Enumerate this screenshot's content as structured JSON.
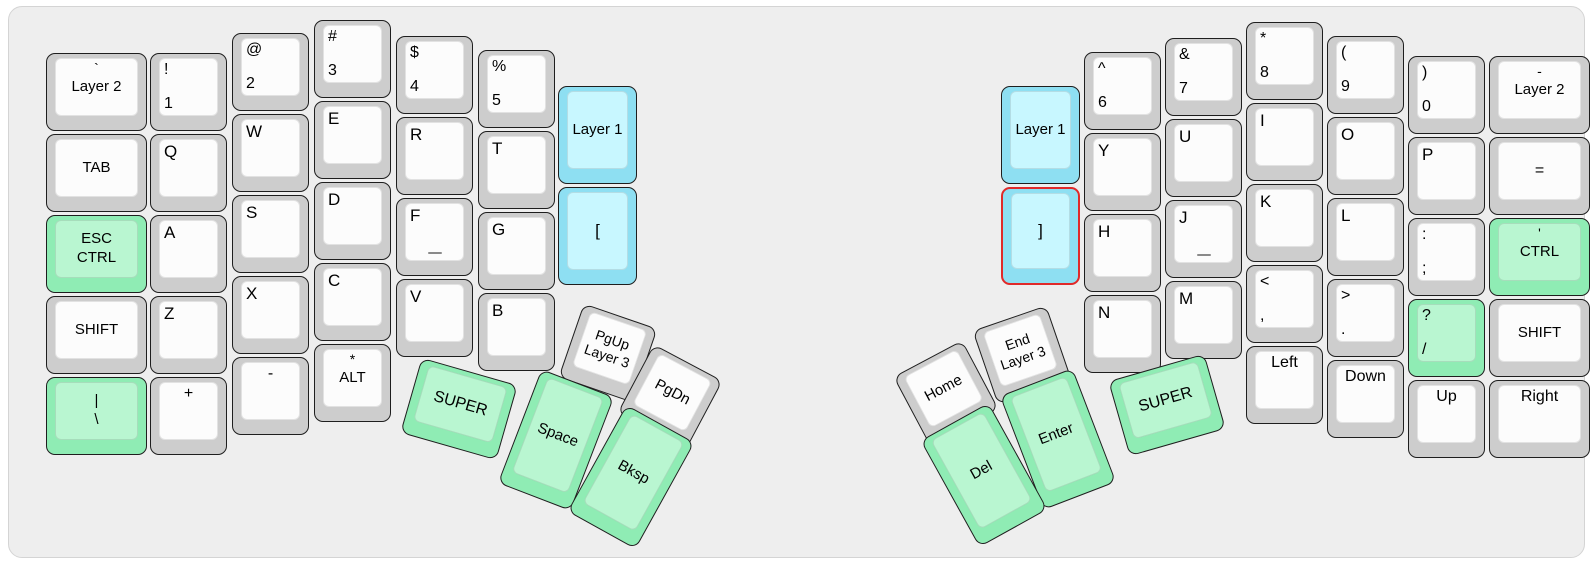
{
  "app": {
    "view_title": "split keyboard layout preview"
  },
  "colors": {
    "board_bg": "#eeeeee",
    "key_border": "#1e1e1e",
    "key_gray": "#cdcdcd",
    "key_gray_top": "#fcfcfc",
    "key_green": "#8fecb4",
    "key_green_top": "#b9f6d1",
    "key_blue": "#8edff2",
    "key_blue_top": "#c8f7ff",
    "red_border": "#e02929"
  },
  "keys": [
    {
      "n": "key-backtick-layer2",
      "x": 37,
      "y": 46,
      "w": 101,
      "h": 78,
      "r": 0,
      "c": "gray",
      "lg": [
        {
          "t": "`",
          "p": "tc",
          "s": 14
        },
        {
          "t": "Layer 2",
          "p": "cc",
          "s": 15
        }
      ]
    },
    {
      "n": "key-tab",
      "x": 37,
      "y": 127,
      "w": 101,
      "h": 78,
      "r": 0,
      "c": "gray",
      "lg": [
        {
          "t": "TAB",
          "p": "cc",
          "s": 15
        }
      ]
    },
    {
      "n": "key-esc-ctrl",
      "x": 37,
      "y": 208,
      "w": 101,
      "h": 78,
      "r": 0,
      "c": "green",
      "lg": [
        {
          "t": "ESC\nCTRL",
          "p": "cc",
          "s": 15
        }
      ]
    },
    {
      "n": "key-shift-left",
      "x": 37,
      "y": 289,
      "w": 101,
      "h": 78,
      "r": 0,
      "c": "gray",
      "lg": [
        {
          "t": "SHIFT",
          "p": "cc",
          "s": 15
        }
      ]
    },
    {
      "n": "key-pipe-backslash",
      "x": 37,
      "y": 370,
      "w": 101,
      "h": 78,
      "r": 0,
      "c": "green",
      "lg": [
        {
          "t": "|\n\\",
          "p": "cc",
          "s": 15
        }
      ]
    },
    {
      "n": "key-exclam-1",
      "x": 141,
      "y": 46,
      "w": 77,
      "h": 78,
      "r": 0,
      "c": "gray",
      "lg": [
        {
          "t": "!",
          "p": "tl",
          "s": 16
        },
        {
          "t": "1",
          "p": "bl",
          "s": 16
        }
      ]
    },
    {
      "n": "key-q",
      "x": 141,
      "y": 127,
      "w": 77,
      "h": 78,
      "r": 0,
      "c": "gray",
      "lg": [
        {
          "t": "Q",
          "p": "tl",
          "s": 17
        }
      ]
    },
    {
      "n": "key-a",
      "x": 141,
      "y": 208,
      "w": 77,
      "h": 78,
      "r": 0,
      "c": "gray",
      "lg": [
        {
          "t": "A",
          "p": "tl",
          "s": 17
        }
      ]
    },
    {
      "n": "key-z",
      "x": 141,
      "y": 289,
      "w": 77,
      "h": 78,
      "r": 0,
      "c": "gray",
      "lg": [
        {
          "t": "Z",
          "p": "tl",
          "s": 17
        }
      ]
    },
    {
      "n": "key-plus",
      "x": 141,
      "y": 370,
      "w": 77,
      "h": 78,
      "r": 0,
      "c": "gray",
      "lg": [
        {
          "t": "+",
          "p": "tc",
          "s": 16
        }
      ]
    },
    {
      "n": "key-at-2",
      "x": 223,
      "y": 26,
      "w": 77,
      "h": 78,
      "r": 0,
      "c": "gray",
      "lg": [
        {
          "t": "@",
          "p": "tl",
          "s": 16
        },
        {
          "t": "2",
          "p": "bl",
          "s": 16
        }
      ]
    },
    {
      "n": "key-w",
      "x": 223,
      "y": 107,
      "w": 77,
      "h": 78,
      "r": 0,
      "c": "gray",
      "lg": [
        {
          "t": "W",
          "p": "tl",
          "s": 17
        }
      ]
    },
    {
      "n": "key-s",
      "x": 223,
      "y": 188,
      "w": 77,
      "h": 78,
      "r": 0,
      "c": "gray",
      "lg": [
        {
          "t": "S",
          "p": "tl",
          "s": 17
        }
      ]
    },
    {
      "n": "key-x",
      "x": 223,
      "y": 269,
      "w": 77,
      "h": 78,
      "r": 0,
      "c": "gray",
      "lg": [
        {
          "t": "X",
          "p": "tl",
          "s": 17
        }
      ]
    },
    {
      "n": "key-minus",
      "x": 223,
      "y": 350,
      "w": 77,
      "h": 78,
      "r": 0,
      "c": "gray",
      "lg": [
        {
          "t": "-",
          "p": "tc",
          "s": 16
        }
      ]
    },
    {
      "n": "key-hash-3",
      "x": 305,
      "y": 13,
      "w": 77,
      "h": 78,
      "r": 0,
      "c": "gray",
      "lg": [
        {
          "t": "#",
          "p": "tl",
          "s": 16
        },
        {
          "t": "3",
          "p": "bl",
          "s": 16
        }
      ]
    },
    {
      "n": "key-e",
      "x": 305,
      "y": 94,
      "w": 77,
      "h": 78,
      "r": 0,
      "c": "gray",
      "lg": [
        {
          "t": "E",
          "p": "tl",
          "s": 17
        }
      ]
    },
    {
      "n": "key-d",
      "x": 305,
      "y": 175,
      "w": 77,
      "h": 78,
      "r": 0,
      "c": "gray",
      "lg": [
        {
          "t": "D",
          "p": "tl",
          "s": 17
        }
      ]
    },
    {
      "n": "key-c",
      "x": 305,
      "y": 256,
      "w": 77,
      "h": 78,
      "r": 0,
      "c": "gray",
      "lg": [
        {
          "t": "C",
          "p": "tl",
          "s": 17
        }
      ]
    },
    {
      "n": "key-star-alt",
      "x": 305,
      "y": 337,
      "w": 77,
      "h": 78,
      "r": 0,
      "c": "gray",
      "lg": [
        {
          "t": "*",
          "p": "tc",
          "s": 14
        },
        {
          "t": "ALT",
          "p": "cc",
          "s": 15
        }
      ]
    },
    {
      "n": "key-dollar-4",
      "x": 387,
      "y": 29,
      "w": 77,
      "h": 78,
      "r": 0,
      "c": "gray",
      "lg": [
        {
          "t": "$",
          "p": "tl",
          "s": 16
        },
        {
          "t": "4",
          "p": "bl",
          "s": 16
        }
      ]
    },
    {
      "n": "key-r",
      "x": 387,
      "y": 110,
      "w": 77,
      "h": 78,
      "r": 0,
      "c": "gray",
      "lg": [
        {
          "t": "R",
          "p": "tl",
          "s": 17
        }
      ]
    },
    {
      "n": "key-f",
      "x": 387,
      "y": 191,
      "w": 77,
      "h": 78,
      "r": 0,
      "c": "gray",
      "hm": true,
      "lg": [
        {
          "t": "F",
          "p": "tl",
          "s": 17
        }
      ]
    },
    {
      "n": "key-v",
      "x": 387,
      "y": 272,
      "w": 77,
      "h": 78,
      "r": 0,
      "c": "gray",
      "lg": [
        {
          "t": "V",
          "p": "tl",
          "s": 17
        }
      ]
    },
    {
      "n": "key-percent-5",
      "x": 469,
      "y": 43,
      "w": 77,
      "h": 78,
      "r": 0,
      "c": "gray",
      "lg": [
        {
          "t": "%",
          "p": "tl",
          "s": 16
        },
        {
          "t": "5",
          "p": "bl",
          "s": 16
        }
      ]
    },
    {
      "n": "key-t",
      "x": 469,
      "y": 124,
      "w": 77,
      "h": 78,
      "r": 0,
      "c": "gray",
      "lg": [
        {
          "t": "T",
          "p": "tl",
          "s": 17
        }
      ]
    },
    {
      "n": "key-g",
      "x": 469,
      "y": 205,
      "w": 77,
      "h": 78,
      "r": 0,
      "c": "gray",
      "lg": [
        {
          "t": "G",
          "p": "tl",
          "s": 17
        }
      ]
    },
    {
      "n": "key-b",
      "x": 469,
      "y": 286,
      "w": 77,
      "h": 78,
      "r": 0,
      "c": "gray",
      "lg": [
        {
          "t": "B",
          "p": "tl",
          "s": 17
        }
      ]
    },
    {
      "n": "key-layer1-left",
      "x": 549,
      "y": 79,
      "w": 79,
      "h": 98,
      "r": 0,
      "c": "blue",
      "lg": [
        {
          "t": "Layer 1",
          "p": "cc",
          "s": 15
        }
      ]
    },
    {
      "n": "key-lbracket",
      "x": 549,
      "y": 180,
      "w": 79,
      "h": 98,
      "r": 0,
      "c": "blue",
      "lg": [
        {
          "t": "[",
          "p": "cc",
          "s": 17
        }
      ]
    },
    {
      "n": "key-pgup-layer3",
      "x": 560,
      "y": 307,
      "w": 78,
      "h": 78,
      "r": 19,
      "c": "gray",
      "lg": [
        {
          "t": "PgUp\nLayer 3",
          "p": "cc",
          "s": 14
        }
      ]
    },
    {
      "n": "key-pgdn",
      "x": 622,
      "y": 351,
      "w": 78,
      "h": 78,
      "r": 28,
      "c": "gray",
      "lg": [
        {
          "t": "PgDn",
          "p": "cc",
          "s": 15
        }
      ]
    },
    {
      "n": "key-super-left",
      "x": 400,
      "y": 363,
      "w": 100,
      "h": 78,
      "r": 16,
      "c": "green",
      "lg": [
        {
          "t": "SUPER",
          "p": "cc",
          "s": 16
        }
      ]
    },
    {
      "n": "key-space",
      "x": 508,
      "y": 372,
      "w": 78,
      "h": 122,
      "r": 21,
      "c": "green",
      "lg": [
        {
          "t": "Space",
          "p": "cc",
          "s": 15
        }
      ]
    },
    {
      "n": "key-bksp",
      "x": 583,
      "y": 409,
      "w": 78,
      "h": 122,
      "r": 29,
      "c": "green",
      "lg": [
        {
          "t": "Bksp",
          "p": "cc",
          "s": 15
        }
      ]
    },
    {
      "n": "key-layer1-right",
      "x": 992,
      "y": 79,
      "w": 79,
      "h": 98,
      "r": 0,
      "c": "blue",
      "lg": [
        {
          "t": "Layer 1",
          "p": "cc",
          "s": 15
        }
      ]
    },
    {
      "n": "key-rbracket",
      "x": 992,
      "y": 180,
      "w": 79,
      "h": 98,
      "r": 0,
      "c": "blue",
      "rb": true,
      "lg": [
        {
          "t": "]",
          "p": "cc",
          "s": 17
        }
      ]
    },
    {
      "n": "key-caret-6",
      "x": 1075,
      "y": 45,
      "w": 77,
      "h": 78,
      "r": 0,
      "c": "gray",
      "lg": [
        {
          "t": "^",
          "p": "tl",
          "s": 16
        },
        {
          "t": "6",
          "p": "bl",
          "s": 16
        }
      ]
    },
    {
      "n": "key-y",
      "x": 1075,
      "y": 126,
      "w": 77,
      "h": 78,
      "r": 0,
      "c": "gray",
      "lg": [
        {
          "t": "Y",
          "p": "tl",
          "s": 17
        }
      ]
    },
    {
      "n": "key-h",
      "x": 1075,
      "y": 207,
      "w": 77,
      "h": 78,
      "r": 0,
      "c": "gray",
      "lg": [
        {
          "t": "H",
          "p": "tl",
          "s": 17
        }
      ]
    },
    {
      "n": "key-n",
      "x": 1075,
      "y": 288,
      "w": 77,
      "h": 78,
      "r": 0,
      "c": "gray",
      "lg": [
        {
          "t": "N",
          "p": "tl",
          "s": 17
        }
      ]
    },
    {
      "n": "key-amp-7",
      "x": 1156,
      "y": 31,
      "w": 77,
      "h": 78,
      "r": 0,
      "c": "gray",
      "lg": [
        {
          "t": "&",
          "p": "tl",
          "s": 16
        },
        {
          "t": "7",
          "p": "bl",
          "s": 16
        }
      ]
    },
    {
      "n": "key-u",
      "x": 1156,
      "y": 112,
      "w": 77,
      "h": 78,
      "r": 0,
      "c": "gray",
      "lg": [
        {
          "t": "U",
          "p": "tl",
          "s": 17
        }
      ]
    },
    {
      "n": "key-j",
      "x": 1156,
      "y": 193,
      "w": 77,
      "h": 78,
      "r": 0,
      "c": "gray",
      "hm": true,
      "lg": [
        {
          "t": "J",
          "p": "tl",
          "s": 17
        }
      ]
    },
    {
      "n": "key-m",
      "x": 1156,
      "y": 274,
      "w": 77,
      "h": 78,
      "r": 0,
      "c": "gray",
      "lg": [
        {
          "t": "M",
          "p": "tl",
          "s": 17
        }
      ]
    },
    {
      "n": "key-star-8",
      "x": 1237,
      "y": 15,
      "w": 77,
      "h": 78,
      "r": 0,
      "c": "gray",
      "lg": [
        {
          "t": "*",
          "p": "tl",
          "s": 16
        },
        {
          "t": "8",
          "p": "bl",
          "s": 16
        }
      ]
    },
    {
      "n": "key-i",
      "x": 1237,
      "y": 96,
      "w": 77,
      "h": 78,
      "r": 0,
      "c": "gray",
      "lg": [
        {
          "t": "I",
          "p": "tl",
          "s": 17
        }
      ]
    },
    {
      "n": "key-k",
      "x": 1237,
      "y": 177,
      "w": 77,
      "h": 78,
      "r": 0,
      "c": "gray",
      "lg": [
        {
          "t": "K",
          "p": "tl",
          "s": 17
        }
      ]
    },
    {
      "n": "key-lt-comma",
      "x": 1237,
      "y": 258,
      "w": 77,
      "h": 78,
      "r": 0,
      "c": "gray",
      "lg": [
        {
          "t": "<",
          "p": "tl",
          "s": 16
        },
        {
          "t": ",",
          "p": "bl",
          "s": 16
        }
      ]
    },
    {
      "n": "key-left",
      "x": 1237,
      "y": 339,
      "w": 77,
      "h": 78,
      "r": 0,
      "c": "gray",
      "lg": [
        {
          "t": "Left",
          "p": "tc",
          "s": 16
        }
      ]
    },
    {
      "n": "key-paren-9",
      "x": 1318,
      "y": 29,
      "w": 77,
      "h": 78,
      "r": 0,
      "c": "gray",
      "lg": [
        {
          "t": "(",
          "p": "tl",
          "s": 16
        },
        {
          "t": "9",
          "p": "bl",
          "s": 16
        }
      ]
    },
    {
      "n": "key-o",
      "x": 1318,
      "y": 110,
      "w": 77,
      "h": 78,
      "r": 0,
      "c": "gray",
      "lg": [
        {
          "t": "O",
          "p": "tl",
          "s": 17
        }
      ]
    },
    {
      "n": "key-l",
      "x": 1318,
      "y": 191,
      "w": 77,
      "h": 78,
      "r": 0,
      "c": "gray",
      "lg": [
        {
          "t": "L",
          "p": "tl",
          "s": 17
        }
      ]
    },
    {
      "n": "key-gt-period",
      "x": 1318,
      "y": 272,
      "w": 77,
      "h": 78,
      "r": 0,
      "c": "gray",
      "lg": [
        {
          "t": ">",
          "p": "tl",
          "s": 16
        },
        {
          "t": ".",
          "p": "bl",
          "s": 16
        }
      ]
    },
    {
      "n": "key-down",
      "x": 1318,
      "y": 353,
      "w": 77,
      "h": 78,
      "r": 0,
      "c": "gray",
      "lg": [
        {
          "t": "Down",
          "p": "tc",
          "s": 16
        }
      ]
    },
    {
      "n": "key-paren-0",
      "x": 1399,
      "y": 49,
      "w": 77,
      "h": 78,
      "r": 0,
      "c": "gray",
      "lg": [
        {
          "t": ")",
          "p": "tl",
          "s": 16
        },
        {
          "t": "0",
          "p": "bl",
          "s": 16
        }
      ]
    },
    {
      "n": "key-p",
      "x": 1399,
      "y": 130,
      "w": 77,
      "h": 78,
      "r": 0,
      "c": "gray",
      "lg": [
        {
          "t": "P",
          "p": "tl",
          "s": 17
        }
      ]
    },
    {
      "n": "key-colon-semicolon",
      "x": 1399,
      "y": 211,
      "w": 77,
      "h": 78,
      "r": 0,
      "c": "gray",
      "lg": [
        {
          "t": ":",
          "p": "tl",
          "s": 16
        },
        {
          "t": ";",
          "p": "bl",
          "s": 16
        }
      ]
    },
    {
      "n": "key-question-slash",
      "x": 1399,
      "y": 292,
      "w": 77,
      "h": 78,
      "r": 0,
      "c": "green",
      "lg": [
        {
          "t": "?",
          "p": "tl",
          "s": 16
        },
        {
          "t": "/",
          "p": "bl",
          "s": 16
        }
      ]
    },
    {
      "n": "key-up",
      "x": 1399,
      "y": 373,
      "w": 77,
      "h": 78,
      "r": 0,
      "c": "gray",
      "lg": [
        {
          "t": "Up",
          "p": "tc",
          "s": 16
        }
      ]
    },
    {
      "n": "key-minus-layer2",
      "x": 1480,
      "y": 49,
      "w": 101,
      "h": 78,
      "r": 0,
      "c": "gray",
      "lg": [
        {
          "t": "-",
          "p": "tc",
          "s": 14
        },
        {
          "t": "Layer 2",
          "p": "cc",
          "s": 15
        }
      ]
    },
    {
      "n": "key-equals",
      "x": 1480,
      "y": 130,
      "w": 101,
      "h": 78,
      "r": 0,
      "c": "gray",
      "lg": [
        {
          "t": "=",
          "p": "cc",
          "s": 16
        }
      ]
    },
    {
      "n": "key-quote-ctrl",
      "x": 1480,
      "y": 211,
      "w": 101,
      "h": 78,
      "r": 0,
      "c": "green",
      "lg": [
        {
          "t": "'",
          "p": "tc",
          "s": 14
        },
        {
          "t": "CTRL",
          "p": "cc",
          "s": 15
        }
      ]
    },
    {
      "n": "key-shift-right",
      "x": 1480,
      "y": 292,
      "w": 101,
      "h": 78,
      "r": 0,
      "c": "gray",
      "lg": [
        {
          "t": "SHIFT",
          "p": "cc",
          "s": 15
        }
      ]
    },
    {
      "n": "key-right",
      "x": 1480,
      "y": 373,
      "w": 101,
      "h": 78,
      "r": 0,
      "c": "gray",
      "lg": [
        {
          "t": "Right",
          "p": "tc",
          "s": 16
        }
      ]
    },
    {
      "n": "key-home",
      "x": 898,
      "y": 347,
      "w": 78,
      "h": 78,
      "r": -28,
      "c": "gray",
      "lg": [
        {
          "t": "Home",
          "p": "cc",
          "s": 15
        }
      ]
    },
    {
      "n": "key-end-layer3",
      "x": 974,
      "y": 309,
      "w": 78,
      "h": 78,
      "r": -19,
      "c": "gray",
      "lg": [
        {
          "t": "End\nLayer 3",
          "p": "cc",
          "s": 14
        }
      ]
    },
    {
      "n": "key-enter",
      "x": 1010,
      "y": 371,
      "w": 78,
      "h": 122,
      "r": -21,
      "c": "green",
      "lg": [
        {
          "t": "Enter",
          "p": "cc",
          "s": 15
        }
      ]
    },
    {
      "n": "key-del",
      "x": 936,
      "y": 407,
      "w": 78,
      "h": 122,
      "r": -29,
      "c": "green",
      "lg": [
        {
          "t": "Del",
          "p": "cc",
          "s": 15
        }
      ]
    },
    {
      "n": "key-super-right",
      "x": 1108,
      "y": 359,
      "w": 100,
      "h": 78,
      "r": -16,
      "c": "green",
      "lg": [
        {
          "t": "SUPER",
          "p": "cc",
          "s": 16
        }
      ]
    }
  ]
}
